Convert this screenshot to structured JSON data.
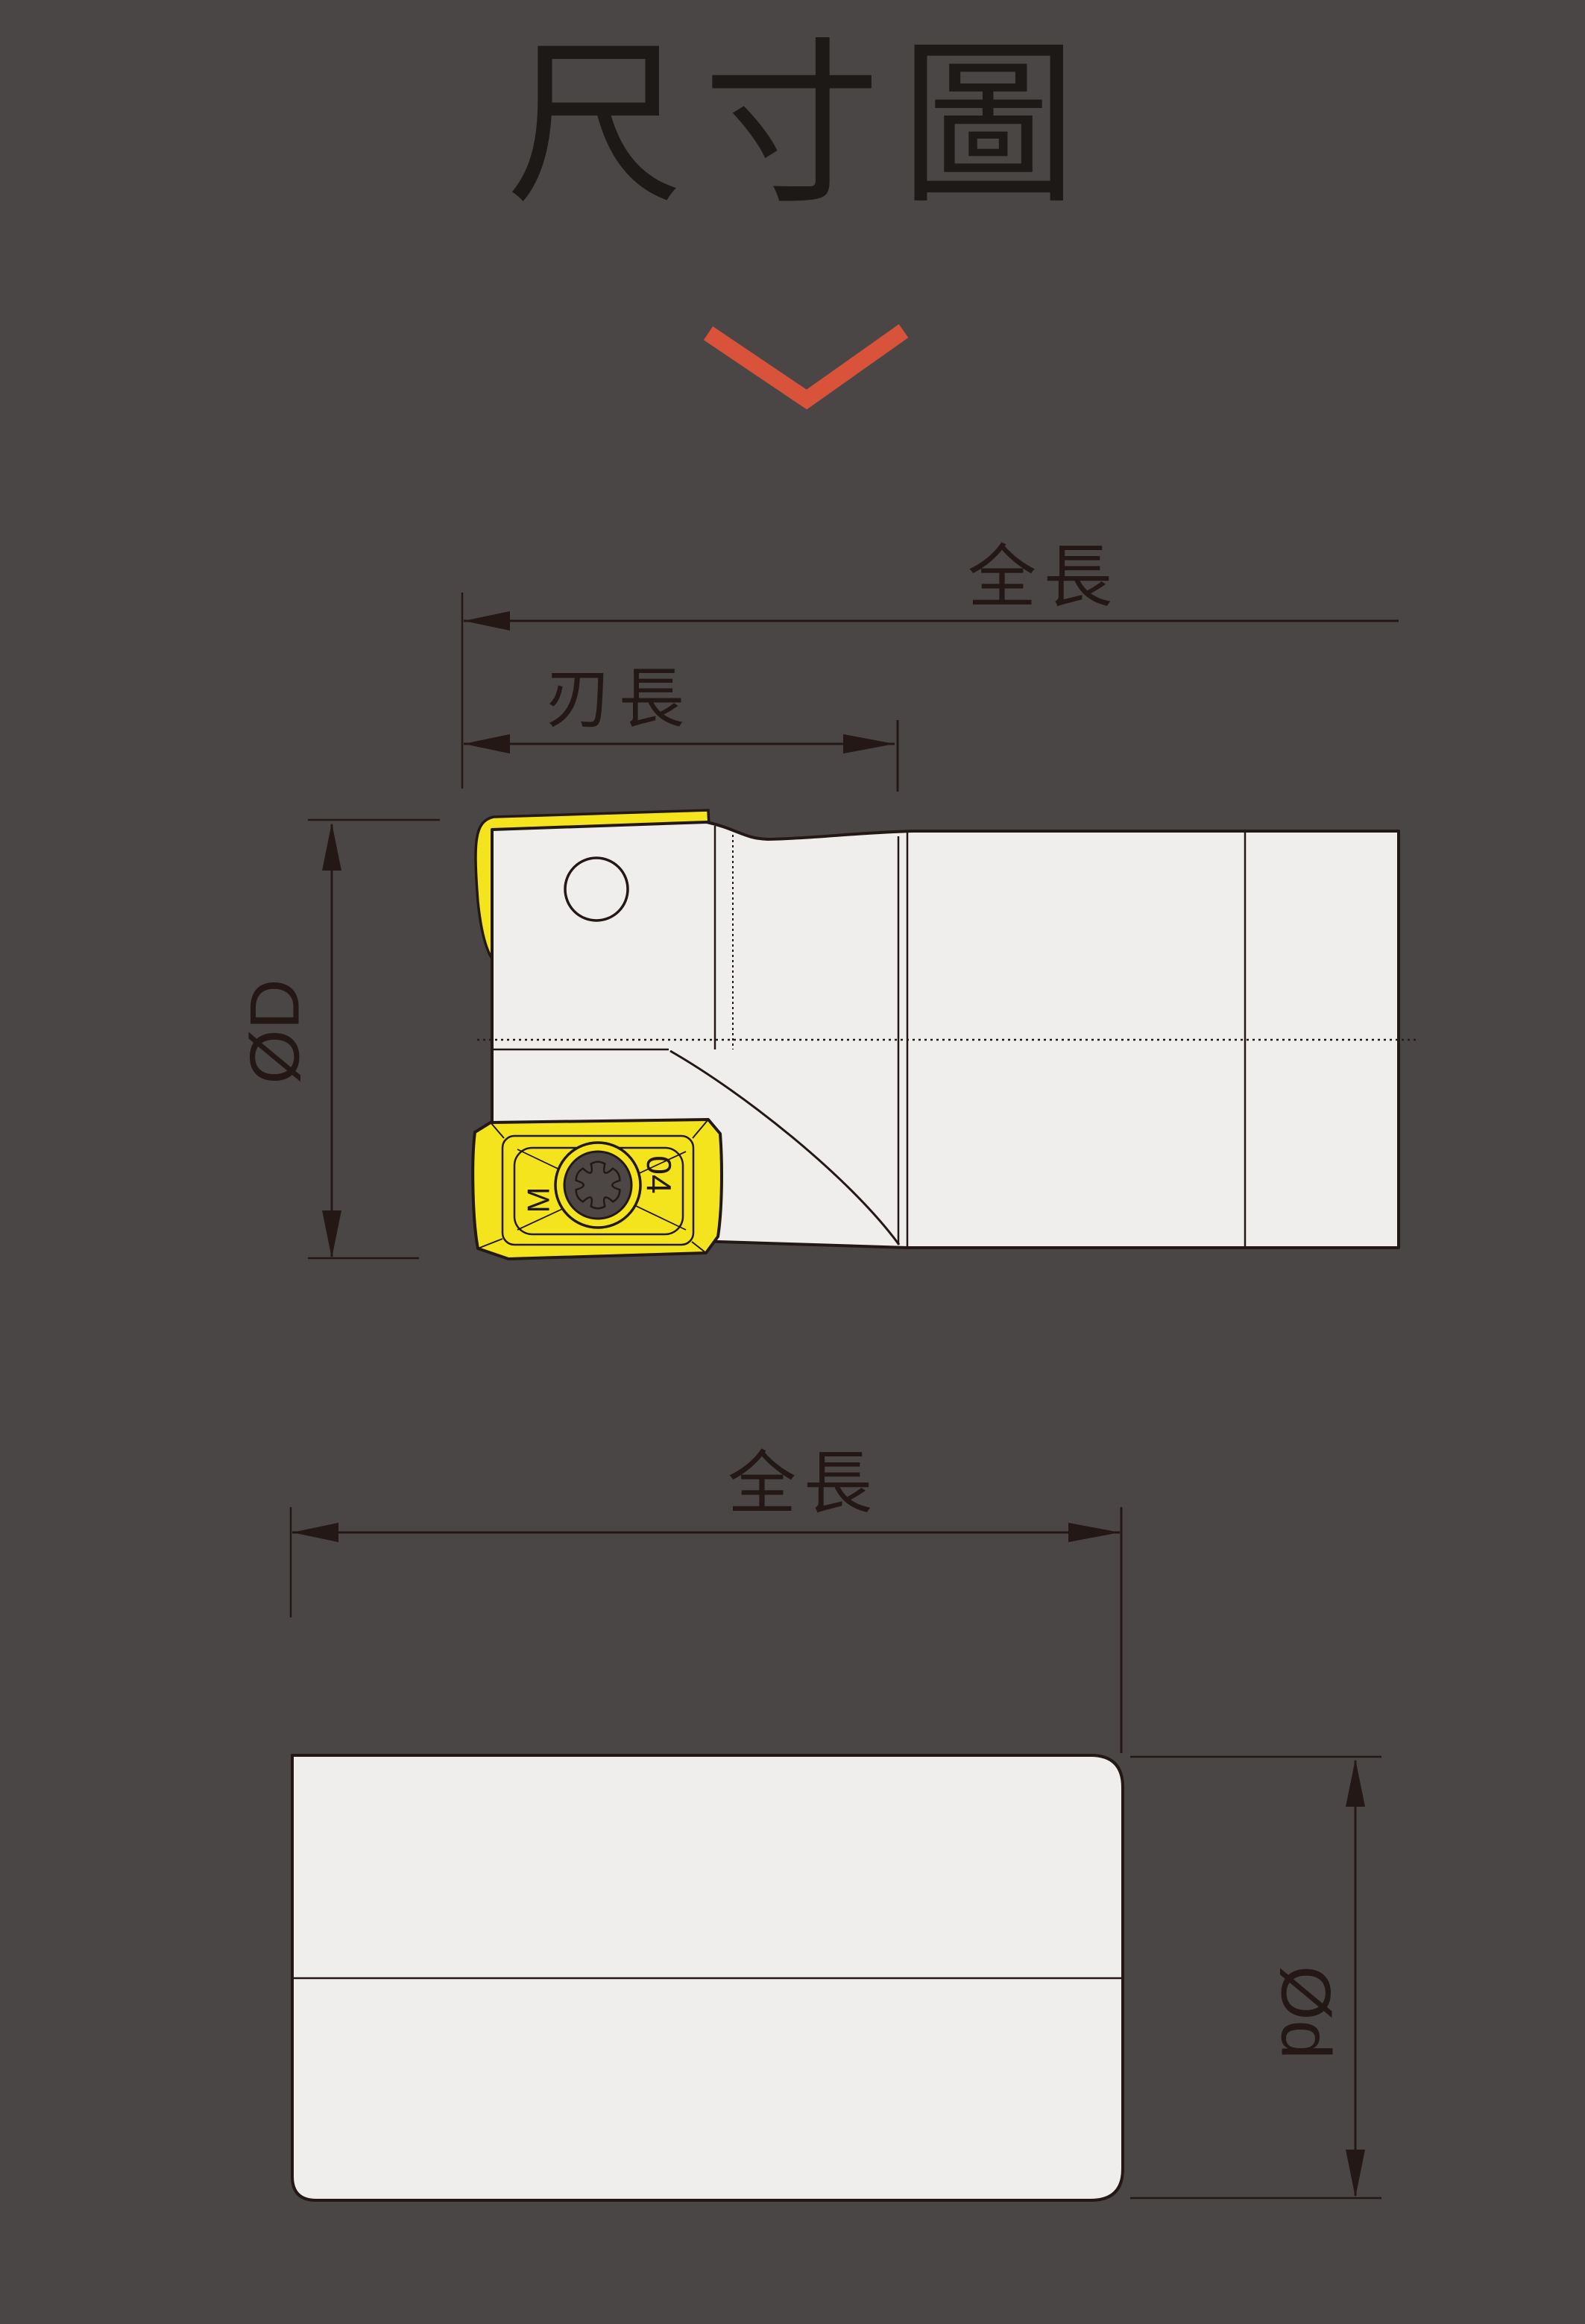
{
  "page": {
    "title": "尺寸圖",
    "background_color": "#4a4645",
    "line_color": "#231815",
    "accent_color": "#d9523a",
    "body_fill": "#efeeec",
    "insert_fill": "#f4e41d",
    "screw_fill": "#4c4745"
  },
  "top_view": {
    "total_length_label": "全長",
    "flute_length_label": "刃長",
    "cutting_diameter_label": "ØD",
    "insert": {
      "left_mark": "M",
      "right_mark": "04"
    }
  },
  "side_view": {
    "total_length_label": "全長",
    "shank_diameter_label": "Ød"
  }
}
